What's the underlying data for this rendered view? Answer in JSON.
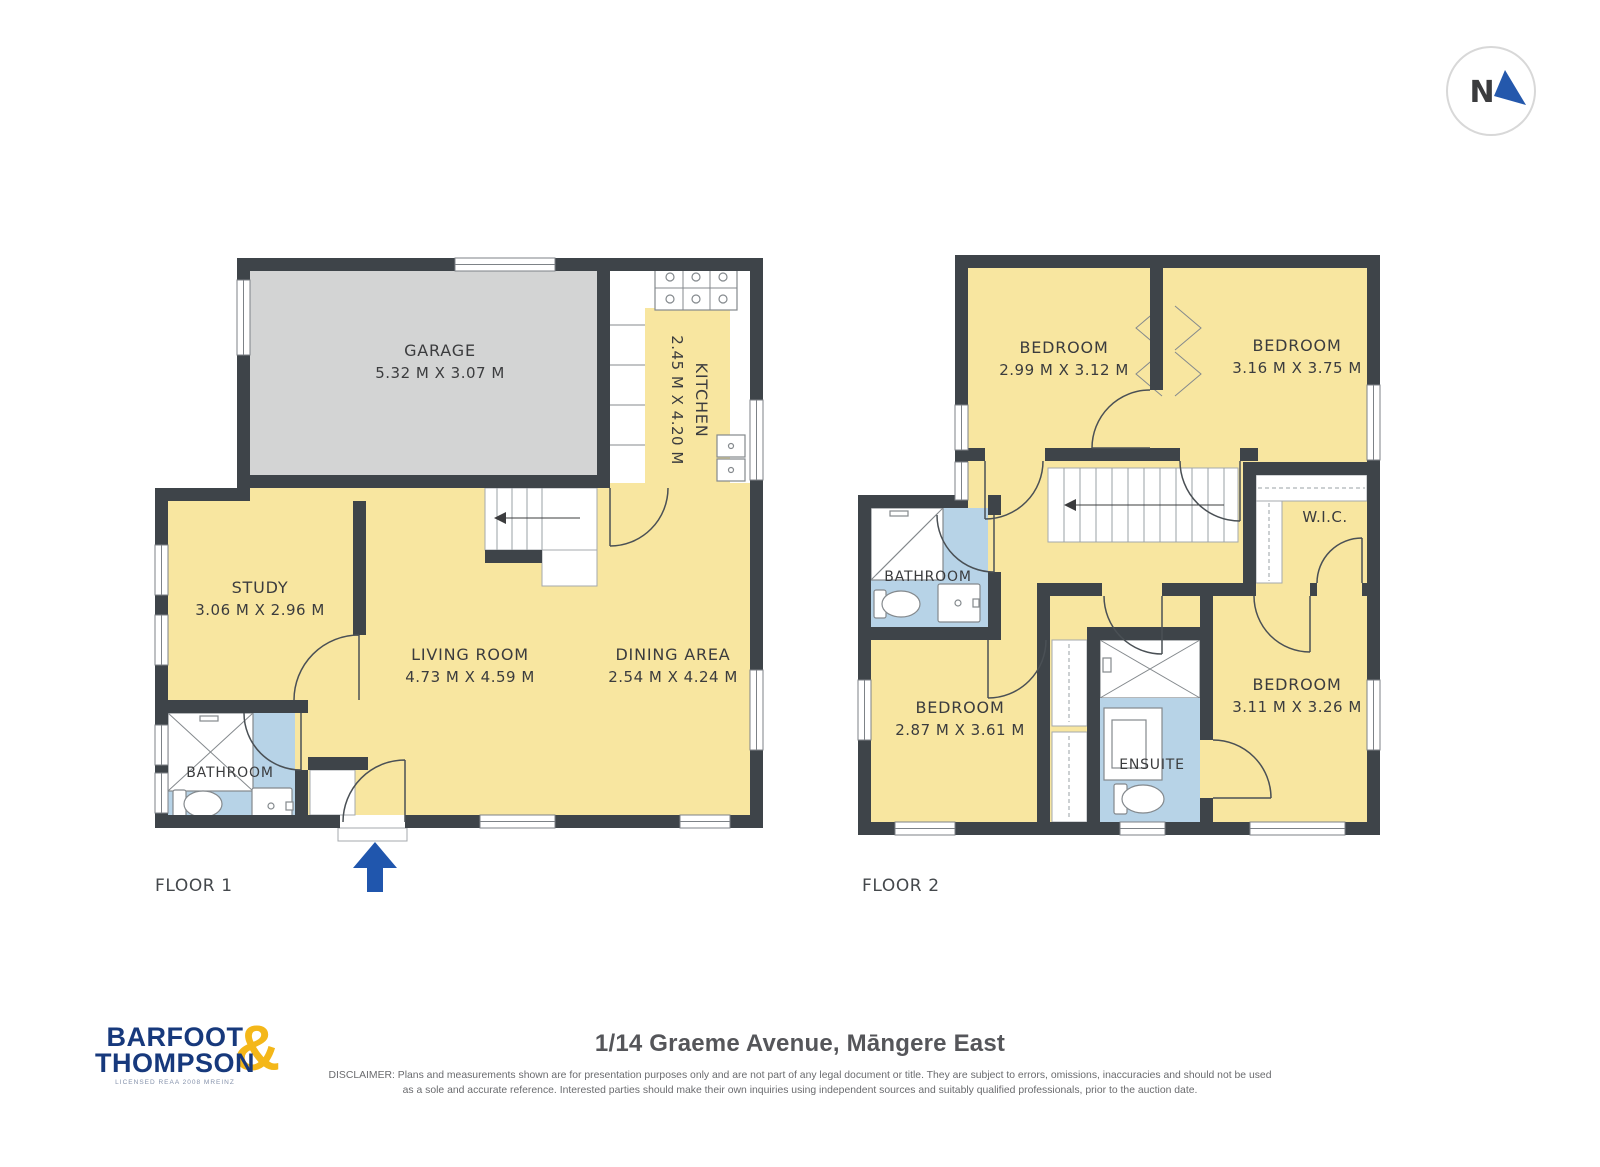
{
  "north_indicator": {
    "label": "N"
  },
  "floor1": {
    "label": "FLOOR 1",
    "rooms": {
      "garage": {
        "name": "GARAGE",
        "dims": "5.32 M X 3.07 M"
      },
      "kitchen": {
        "name": "KITCHEN",
        "dims": "2.45 M X 4.20 M"
      },
      "study": {
        "name": "STUDY",
        "dims": "3.06 M X 2.96 M"
      },
      "living": {
        "name": "LIVING ROOM",
        "dims": "4.73 M X 4.59 M"
      },
      "dining": {
        "name": "DINING AREA",
        "dims": "2.54 M X 4.24 M"
      },
      "bathroom": {
        "name": "BATHROOM"
      }
    }
  },
  "floor2": {
    "label": "FLOOR 2",
    "rooms": {
      "bedroom1": {
        "name": "BEDROOM",
        "dims": "2.99 M X 3.12 M"
      },
      "bedroom2": {
        "name": "BEDROOM",
        "dims": "3.16 M X 3.75 M"
      },
      "wic": {
        "name": "W.I.C."
      },
      "bathroom": {
        "name": "BATHROOM"
      },
      "bedroom3": {
        "name": "BEDROOM",
        "dims": "2.87 M X 3.61 M"
      },
      "ensuite": {
        "name": "ENSUITE"
      },
      "bedroom4": {
        "name": "BEDROOM",
        "dims": "3.11 M X 3.26 M"
      }
    }
  },
  "footer": {
    "brand_line1": "BARFOOT",
    "brand_line2": "THOMPSON",
    "brand_amp": "&",
    "brand_sub": "LICENSED REAA 2008 MREINZ",
    "title": "1/14 Graeme Avenue, Māngere East",
    "disclaimer_line1": "DISCLAIMER: Plans and measurements shown are for presentation purposes only and are not part of any legal document or title. They are subject to errors, omissions, inaccuracies and should not be used",
    "disclaimer_line2": "as a sole and accurate reference. Interested parties should make their own inquiries using independent sources and suitably qualified professionals, prior to the auction date."
  },
  "colors": {
    "wall": "#3e4449",
    "room_yellow": "#f8e6a0",
    "garage_gray": "#d3d4d4",
    "wet_area_blue": "#b7d3e7",
    "brand_navy": "#17397c",
    "brand_gold": "#f4b719",
    "arrow_blue": "#2056ad"
  }
}
